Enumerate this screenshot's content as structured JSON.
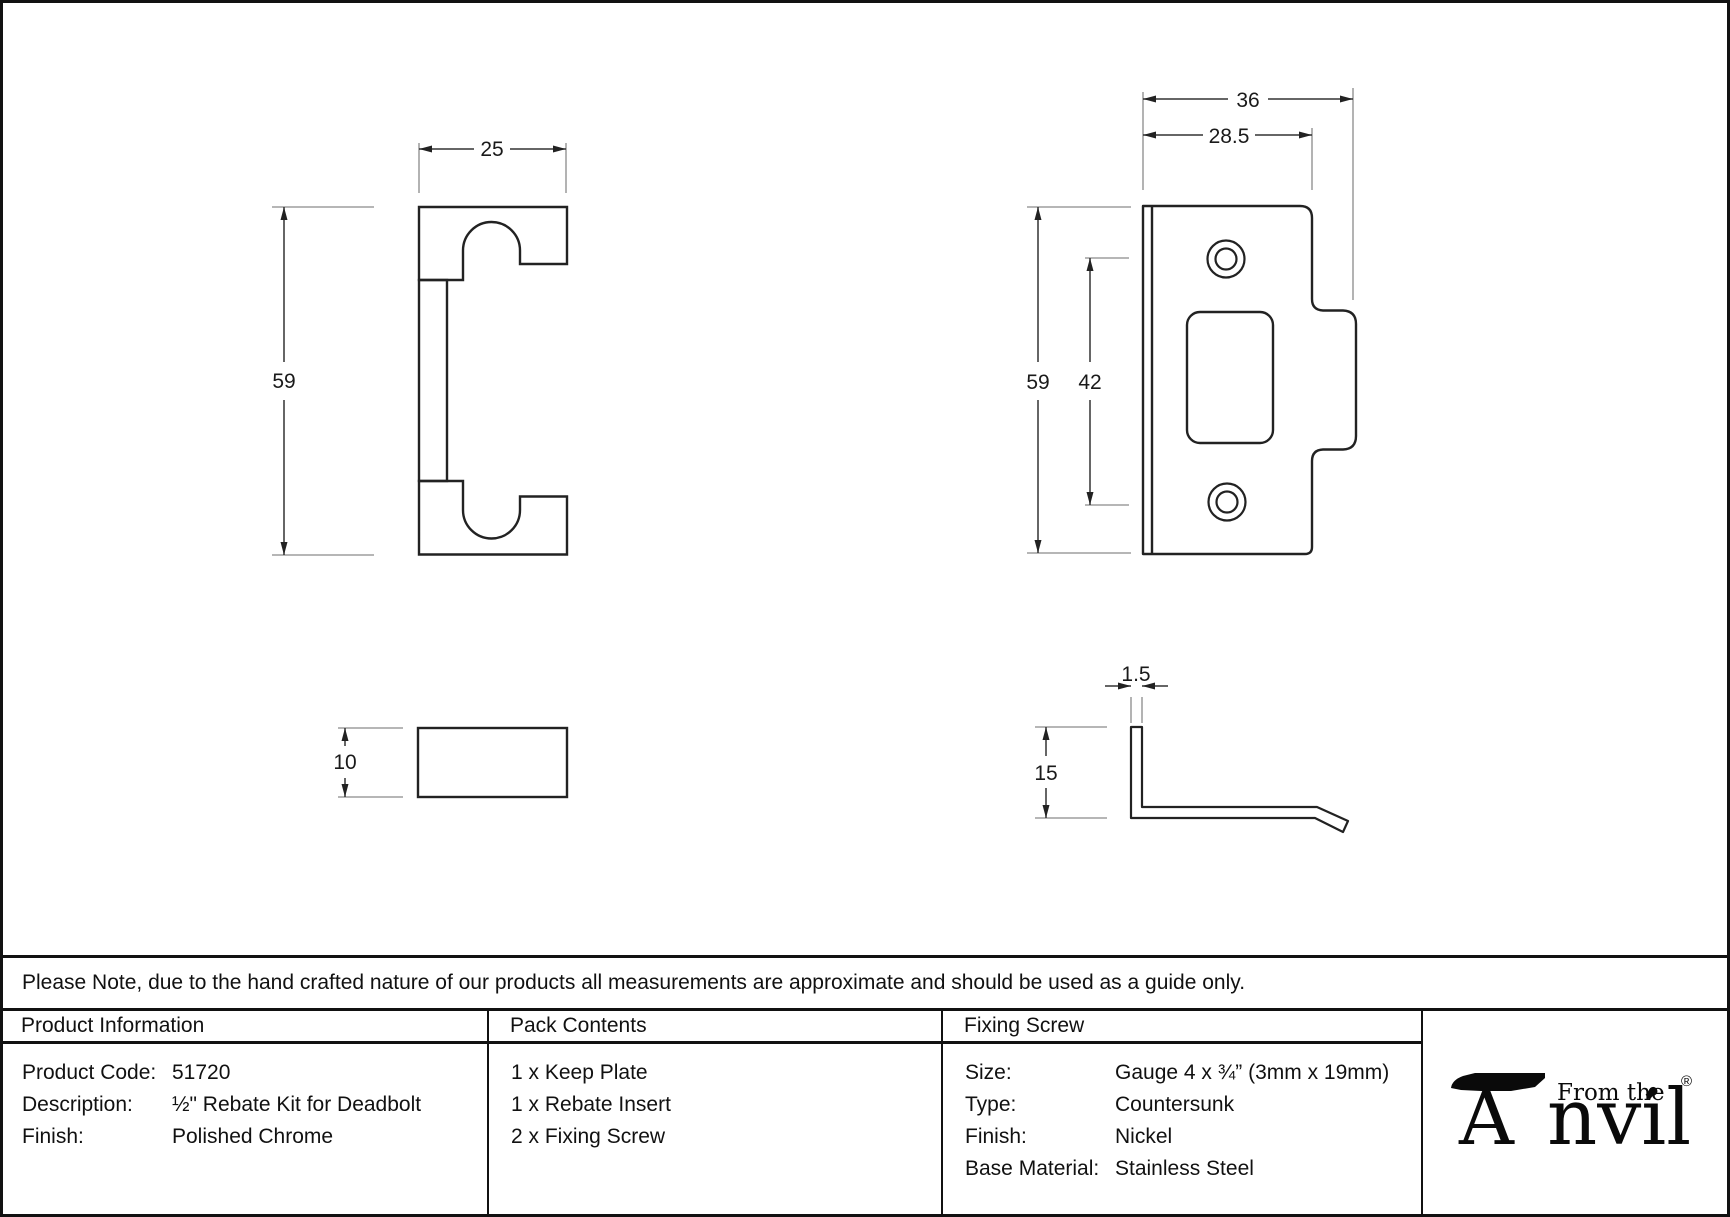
{
  "note": "Please Note, due to the hand crafted nature of our products all measurements are approximate and should be used as a guide only.",
  "drawings": {
    "insert_front": {
      "width": "25",
      "height": "59"
    },
    "insert_side": {
      "thickness": "10"
    },
    "keep_front": {
      "overall_width": "36",
      "plate_width": "28.5",
      "height": "59",
      "hole_spacing": "42"
    },
    "keep_side": {
      "thickness": "1.5",
      "lip_height": "15"
    }
  },
  "table": {
    "product_information": {
      "header": "Product Information",
      "rows": [
        {
          "label": "Product Code:",
          "value": "51720"
        },
        {
          "label": "Description:",
          "value": "½\" Rebate Kit for Deadbolt"
        },
        {
          "label": "Finish:",
          "value": "Polished Chrome"
        }
      ]
    },
    "pack_contents": {
      "header": "Pack Contents",
      "items": [
        "1 x Keep Plate",
        "1 x Rebate Insert",
        "2 x Fixing Screw"
      ]
    },
    "fixing_screw": {
      "header": "Fixing Screw",
      "rows": [
        {
          "label": "Size:",
          "value": "Gauge 4 x ¾” (3mm x 19mm)"
        },
        {
          "label": "Type:",
          "value": "Countersunk"
        },
        {
          "label": "Finish:",
          "value": "Nickel"
        },
        {
          "label": "Base Material:",
          "value": "Stainless Steel"
        }
      ]
    }
  },
  "logo": {
    "brand_a": "A",
    "brand_rest": "nvil",
    "prefix": "From the",
    "diamond": "♦",
    "registered": "®"
  }
}
